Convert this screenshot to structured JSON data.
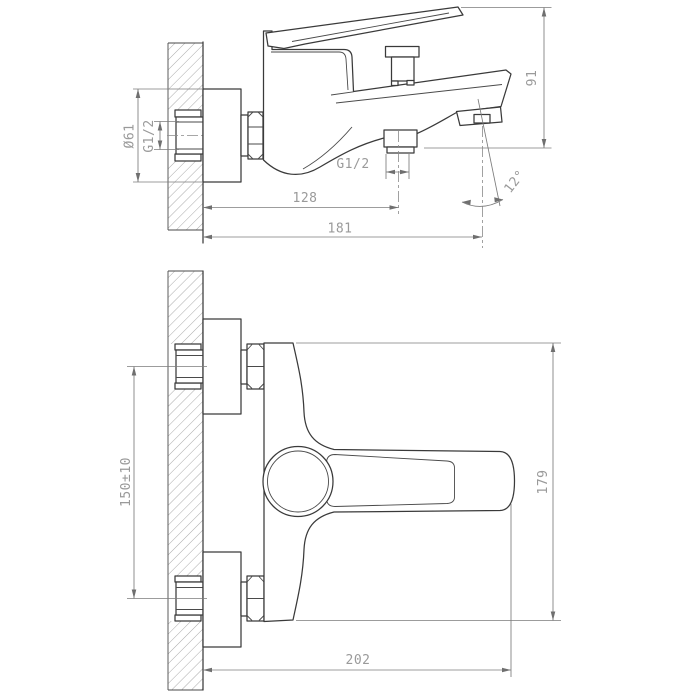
{
  "drawing": {
    "colors": {
      "background": "#ffffff",
      "object_line": "#3a3a3a",
      "dimension_line": "#7c7c7c",
      "label_text": "#9a9a9a"
    },
    "side_view": {
      "labels": {
        "flange_diameter": "Ø61",
        "inlet_thread": "G1/2",
        "outlet_thread": "G1/2",
        "wall_to_outlet": "128",
        "wall_to_spout_tip": "181",
        "height": "91",
        "spout_angle": "12°"
      }
    },
    "front_view": {
      "labels": {
        "inlet_spacing": "150±10",
        "body_height": "179",
        "overall_width": "202"
      }
    }
  }
}
